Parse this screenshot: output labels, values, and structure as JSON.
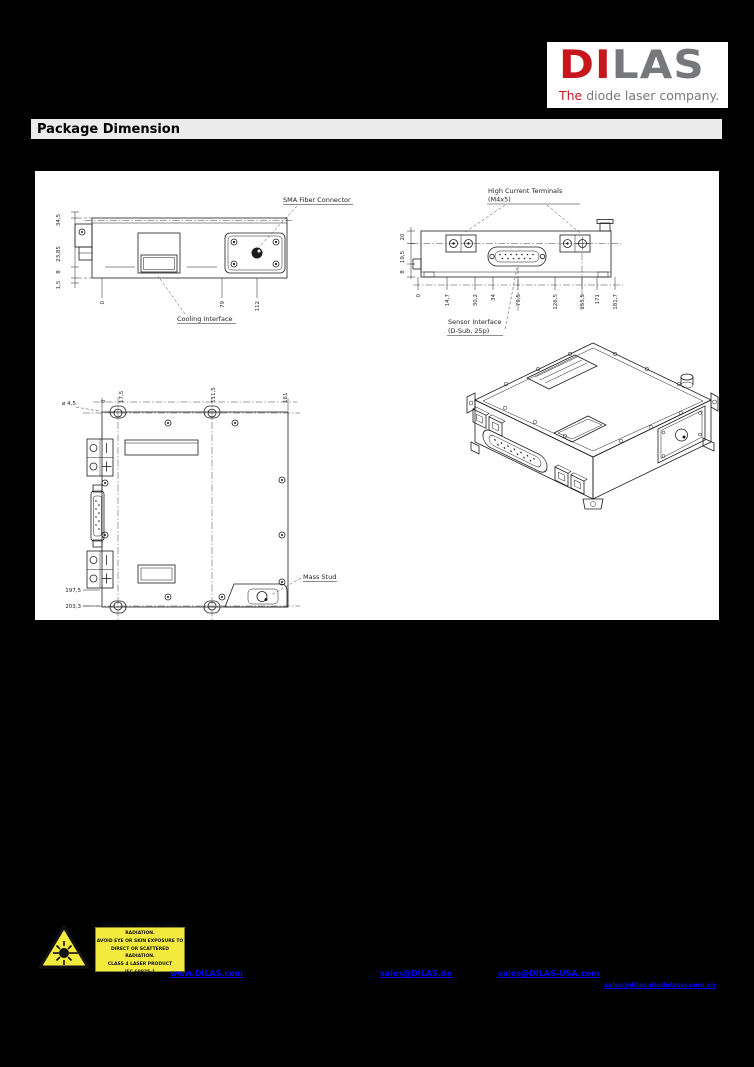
{
  "logo": {
    "word_red": "DI",
    "word_gray": "LAS",
    "tagline_red": "The",
    "tagline_gray": " diode laser company.",
    "red": "#c8161d",
    "gray": "#77787b"
  },
  "header": {
    "title": "Package Dimension"
  },
  "drawings": {
    "top_view": {
      "sma_label": "SMA Fiber Connector",
      "cooling_label": "Cooling Interface",
      "left_dims": [
        "34,5",
        "23,85",
        "8",
        "1,5"
      ],
      "bottom_dims": [
        "0",
        "79",
        "112"
      ]
    },
    "rear_view": {
      "terminals_label_1": "High Current Terminals",
      "terminals_label_2": "(M4x5)",
      "sensor_label_1": "Sensor Interface",
      "sensor_label_2": "(D-Sub, 25p)",
      "left_dims": [
        "20",
        "19,5",
        "8"
      ],
      "bottom_dims": [
        "0",
        "14,7",
        "30,2",
        "34",
        "79,5",
        "126,5",
        "155,5",
        "171",
        "181,7"
      ]
    },
    "bottom_view": {
      "stud_label": "Mass Stud",
      "top_dims": [
        "0",
        "17,5",
        "111,5",
        "161"
      ],
      "hole_dim": "ø 4,5",
      "left_dims": [
        "197,5",
        "203,3"
      ]
    }
  },
  "warning": {
    "lines": [
      "VISIBLE AND INVISIBLE LASER RADIATION.",
      "AVOID EYE OR SKIN EXPOSURE TO",
      "DIRECT OR SCATTERED RADIATION.",
      "CLASS 4 LASER PRODUCT",
      "IEC 60825-1"
    ],
    "yellow": "#f2ea3d"
  },
  "links": {
    "website": "www.DILAS.com",
    "email_de": "sales@DILAS.de",
    "email_usa": "sales@DILAS-USA.com",
    "email_cn": "sales@dilas-diodelaser.com.cn",
    "blue": "#0000ff"
  }
}
